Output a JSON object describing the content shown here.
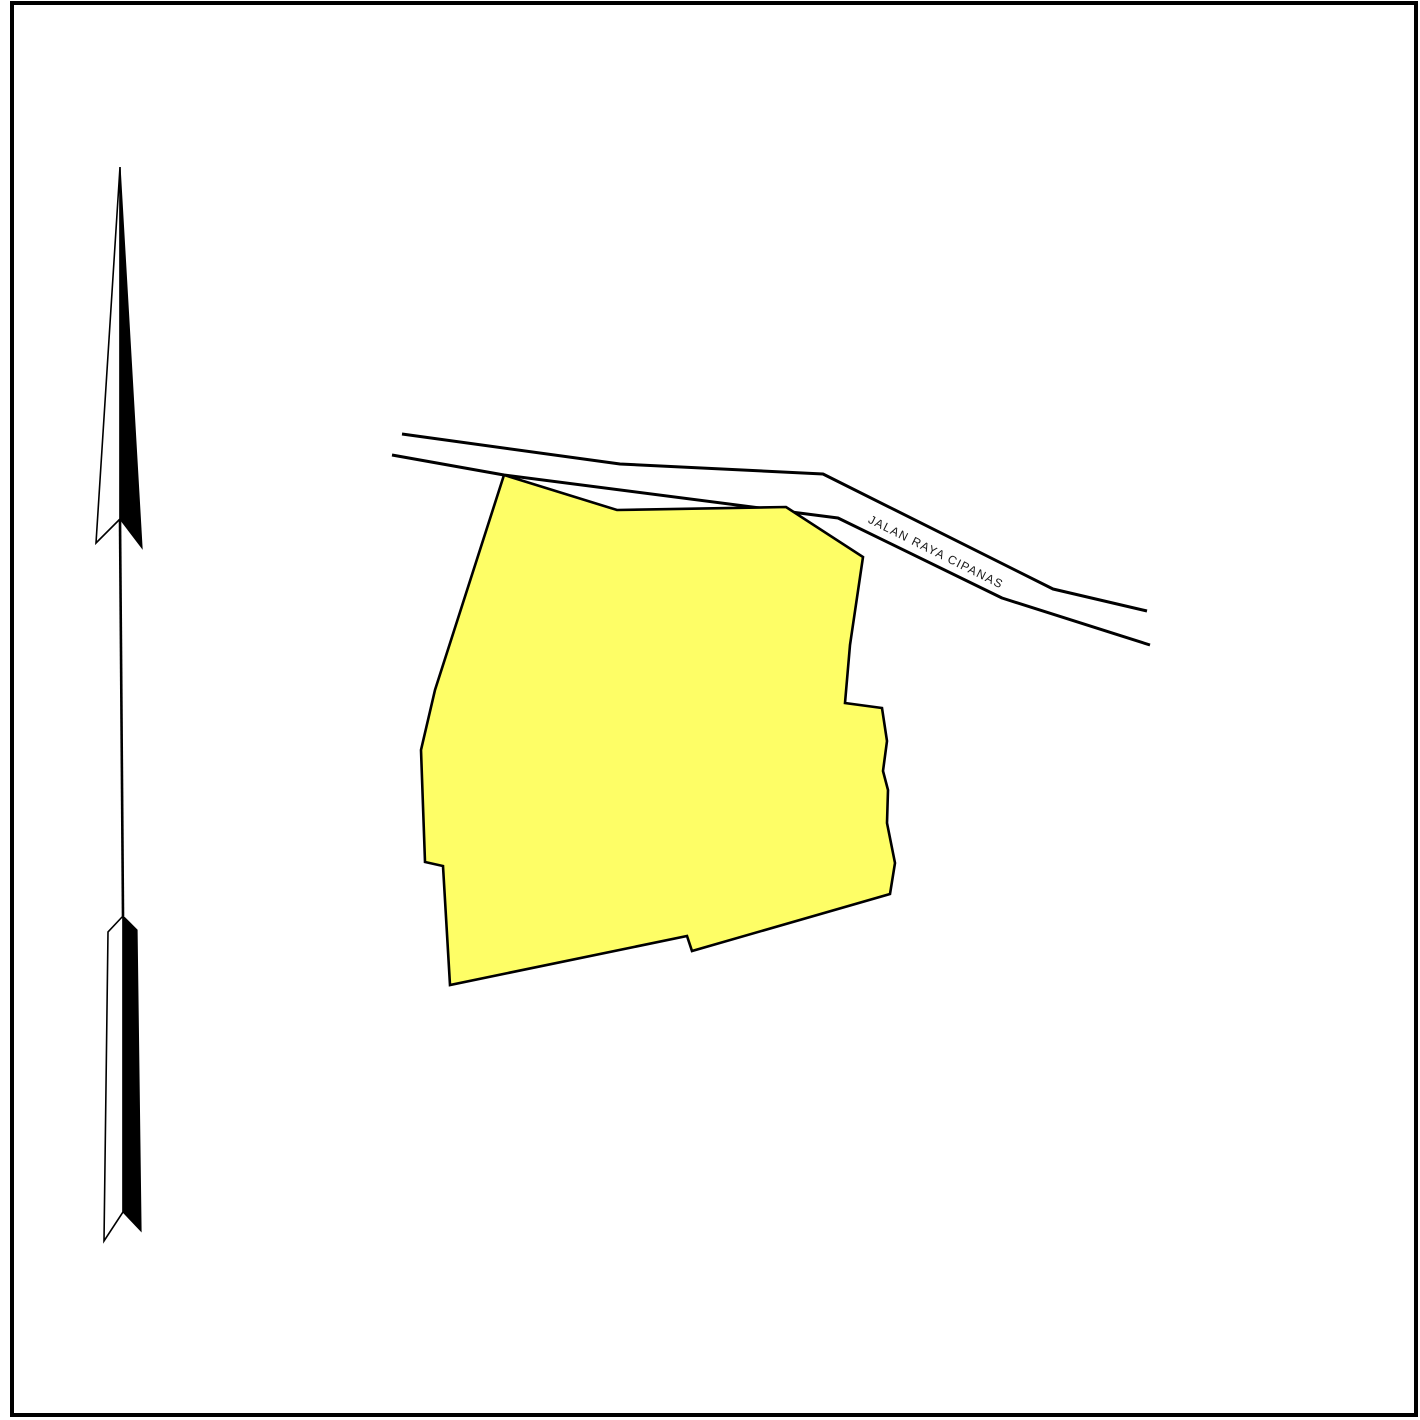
{
  "map": {
    "road_label": "JALAN RAYA CIPANAS"
  },
  "colors": {
    "parcel_fill": "#FEFE66",
    "line_color": "#000000",
    "background": "#FFFFFF"
  },
  "icons": {
    "north_arrow": "north-arrow-icon"
  }
}
